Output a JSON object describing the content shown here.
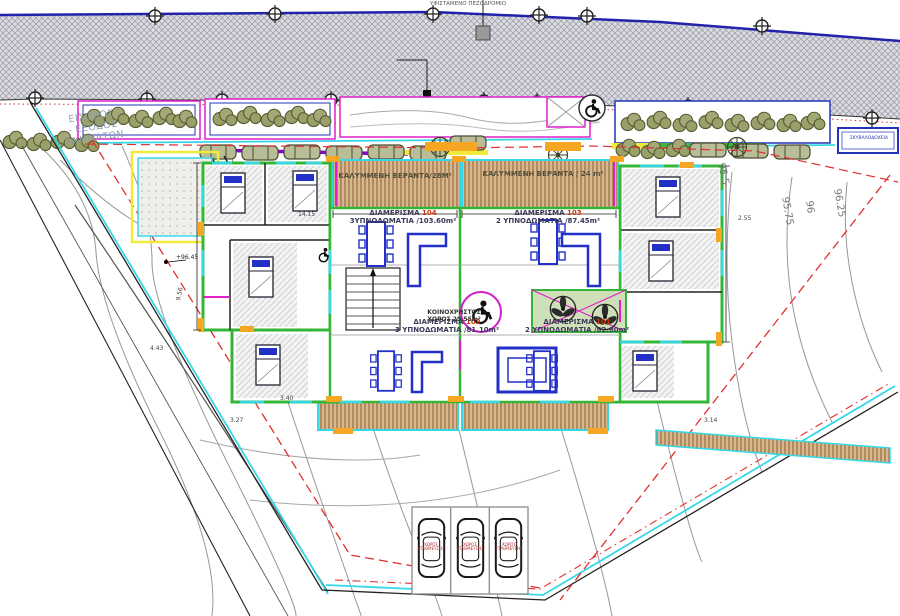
{
  "road": {
    "note": "ΥΦΙΣΤΑΜΕΝΟ ΠΕΖΟΔΡΟΜΙΟ"
  },
  "entrance": {
    "label": "ΕΙΣΟΔΟΣ\n- ΕΞΟΔΟΣ\nΟΧΗΜΑΤΩΝ"
  },
  "bins": {
    "label": "ΣΚΥΒΑΛΟΔΟΧΕΙΑ"
  },
  "apartments": [
    {
      "name": "ΔΙΑΜΕΡΙΣΜΑ",
      "number": "104",
      "details": "3ΥΠΝΟΔΩΜΑΤΙΑ /103.60m²"
    },
    {
      "name": "ΔΙΑΜΕΡΙΣΜΑ",
      "number": "103",
      "details": "2 ΥΠΝΟΔΩΜΑΤΙΑ /87.45m²"
    },
    {
      "name": "ΔΙΑΜΕΡΙΣΜΑ",
      "number": "102",
      "details": "3 ΥΠΝΟΔΩΜΑΤΙΑ /81.10m²"
    },
    {
      "name": "ΔΙΑΜΕΡΙΣΜΑ",
      "number": "101",
      "details": "2 ΥΠΝΟΔΩΜΑΤΙΑ /82.80m²"
    }
  ],
  "verandas": [
    {
      "label": "ΚΑΛΥΜΜΕΝΗ ΒΕΡΑΝΤΑ/28Μ²"
    },
    {
      "label": "ΚΑΛΥΜΜΕΝΗ ΒΕΡΑΝΤΑ / 24 m²"
    }
  ],
  "common_area": {
    "line1": "ΚΟΙΝΟΧΡΗΣΤΟΣ",
    "line2": "ΧΩΡΟΣ 29.55m²"
  },
  "parking": {
    "stall_label": "ΧΩΡΟΣ ΣΤΑΘΜΕΥΣΗΣ"
  },
  "levels": {
    "spot": "+96.45",
    "contours": [
      "95.5",
      "95.75",
      "96",
      "96.25"
    ]
  },
  "dimensions": [
    "14.15",
    "2.55",
    "9.56",
    "4.43",
    "3.27",
    "3.40",
    "3.14"
  ],
  "colors": {
    "wall_green": "#35b535",
    "accent_orange": "#f5a623",
    "frame_cyan": "#35d8e8",
    "partition_magenta": "#e020c8",
    "furniture_blue": "#2230c8",
    "setback_red": "#e03030",
    "road_blue": "#2222aa",
    "wood": "#d8b88e"
  }
}
